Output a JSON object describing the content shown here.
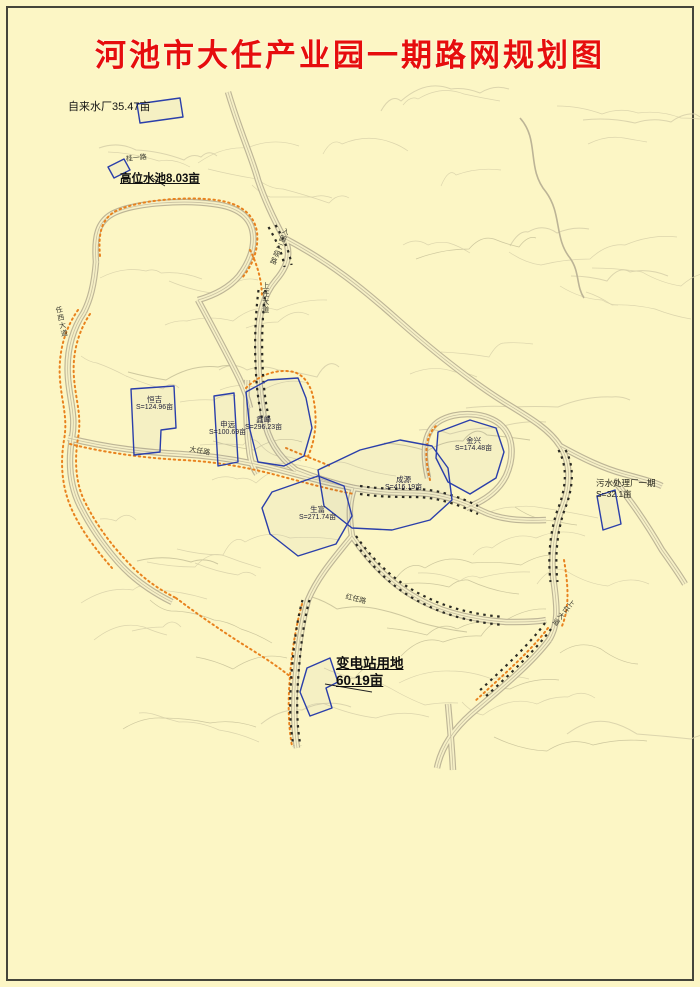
{
  "title": "河池市大任产业园一期路网规划图",
  "annotations": {
    "water_plant": {
      "label": "自来水厂35.47亩"
    },
    "high_pool": {
      "label": "高位水池8.03亩"
    },
    "sewage_plant": {
      "name": "污水处理厂一期",
      "area": "S=32.1亩"
    },
    "substation": {
      "name": "变电站用地",
      "area": "60.19亩"
    }
  },
  "parcels": [
    {
      "name": "恒吉",
      "area": "S=124.96亩"
    },
    {
      "name": "申远",
      "area": "S=100.69亩"
    },
    {
      "name": "鑫峰",
      "area": "S=296.23亩"
    },
    {
      "name": "成源",
      "area": "S=416.19亩"
    },
    {
      "name": "金兴",
      "area": "S=174.48亩"
    },
    {
      "name": "生富",
      "area": "S=271.74亩"
    }
  ],
  "roads": {
    "entry_secondary": "入园二级路",
    "shangren_avenue": "上任大道",
    "daren_road": "大任路",
    "hongren_road": "红任路",
    "gui_yi_road": "桂一路",
    "renxi_avenue": "任西大道"
  },
  "colors": {
    "background": "#fcf6c5",
    "title_red": "#e60d0d",
    "parcel_blue": "#2b3faa",
    "boundary_orange": "#e8821e",
    "road_casing": "#b9b194",
    "contour": "#d6cfa8"
  }
}
